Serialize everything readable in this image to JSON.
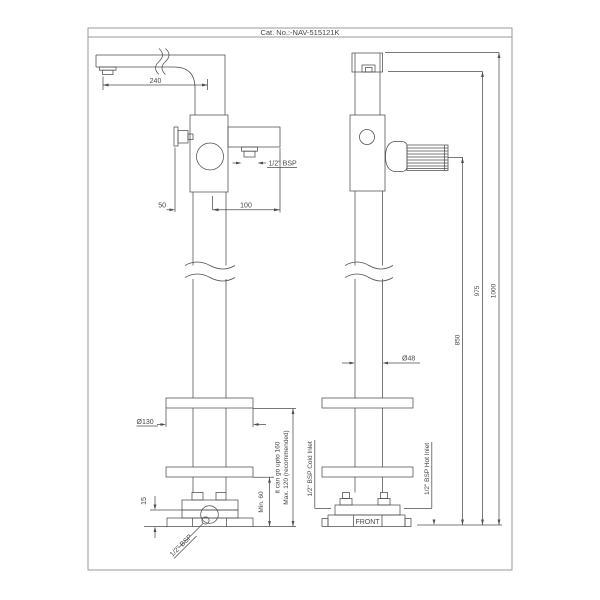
{
  "sheet": {
    "catalog_number": "Cat. No.:-NAV-515121K"
  },
  "side_view": {
    "spout_reach": "240",
    "shower_outlet_thread": "1/2\" BSP",
    "handle_offset": "50",
    "outlet_arm_length": "100",
    "flange_diameter": "Ø130",
    "base_plate_height": "15",
    "min_base_height": "Min. 60",
    "max_base_height_line1": "Max. 120 (recommended)",
    "max_base_height_line2": "it can go upto 160",
    "base_inlet_thread": "1/2\" BSP"
  },
  "front_view": {
    "column_diameter": "Ø48",
    "handle_height": "850",
    "spout_height": "975",
    "overall_height": "1000",
    "cold_inlet": "1/2\" BSP Cold Inlet",
    "hot_inlet": "1/2\" BSP Hot Inlet",
    "front_marking": "FRONT"
  }
}
